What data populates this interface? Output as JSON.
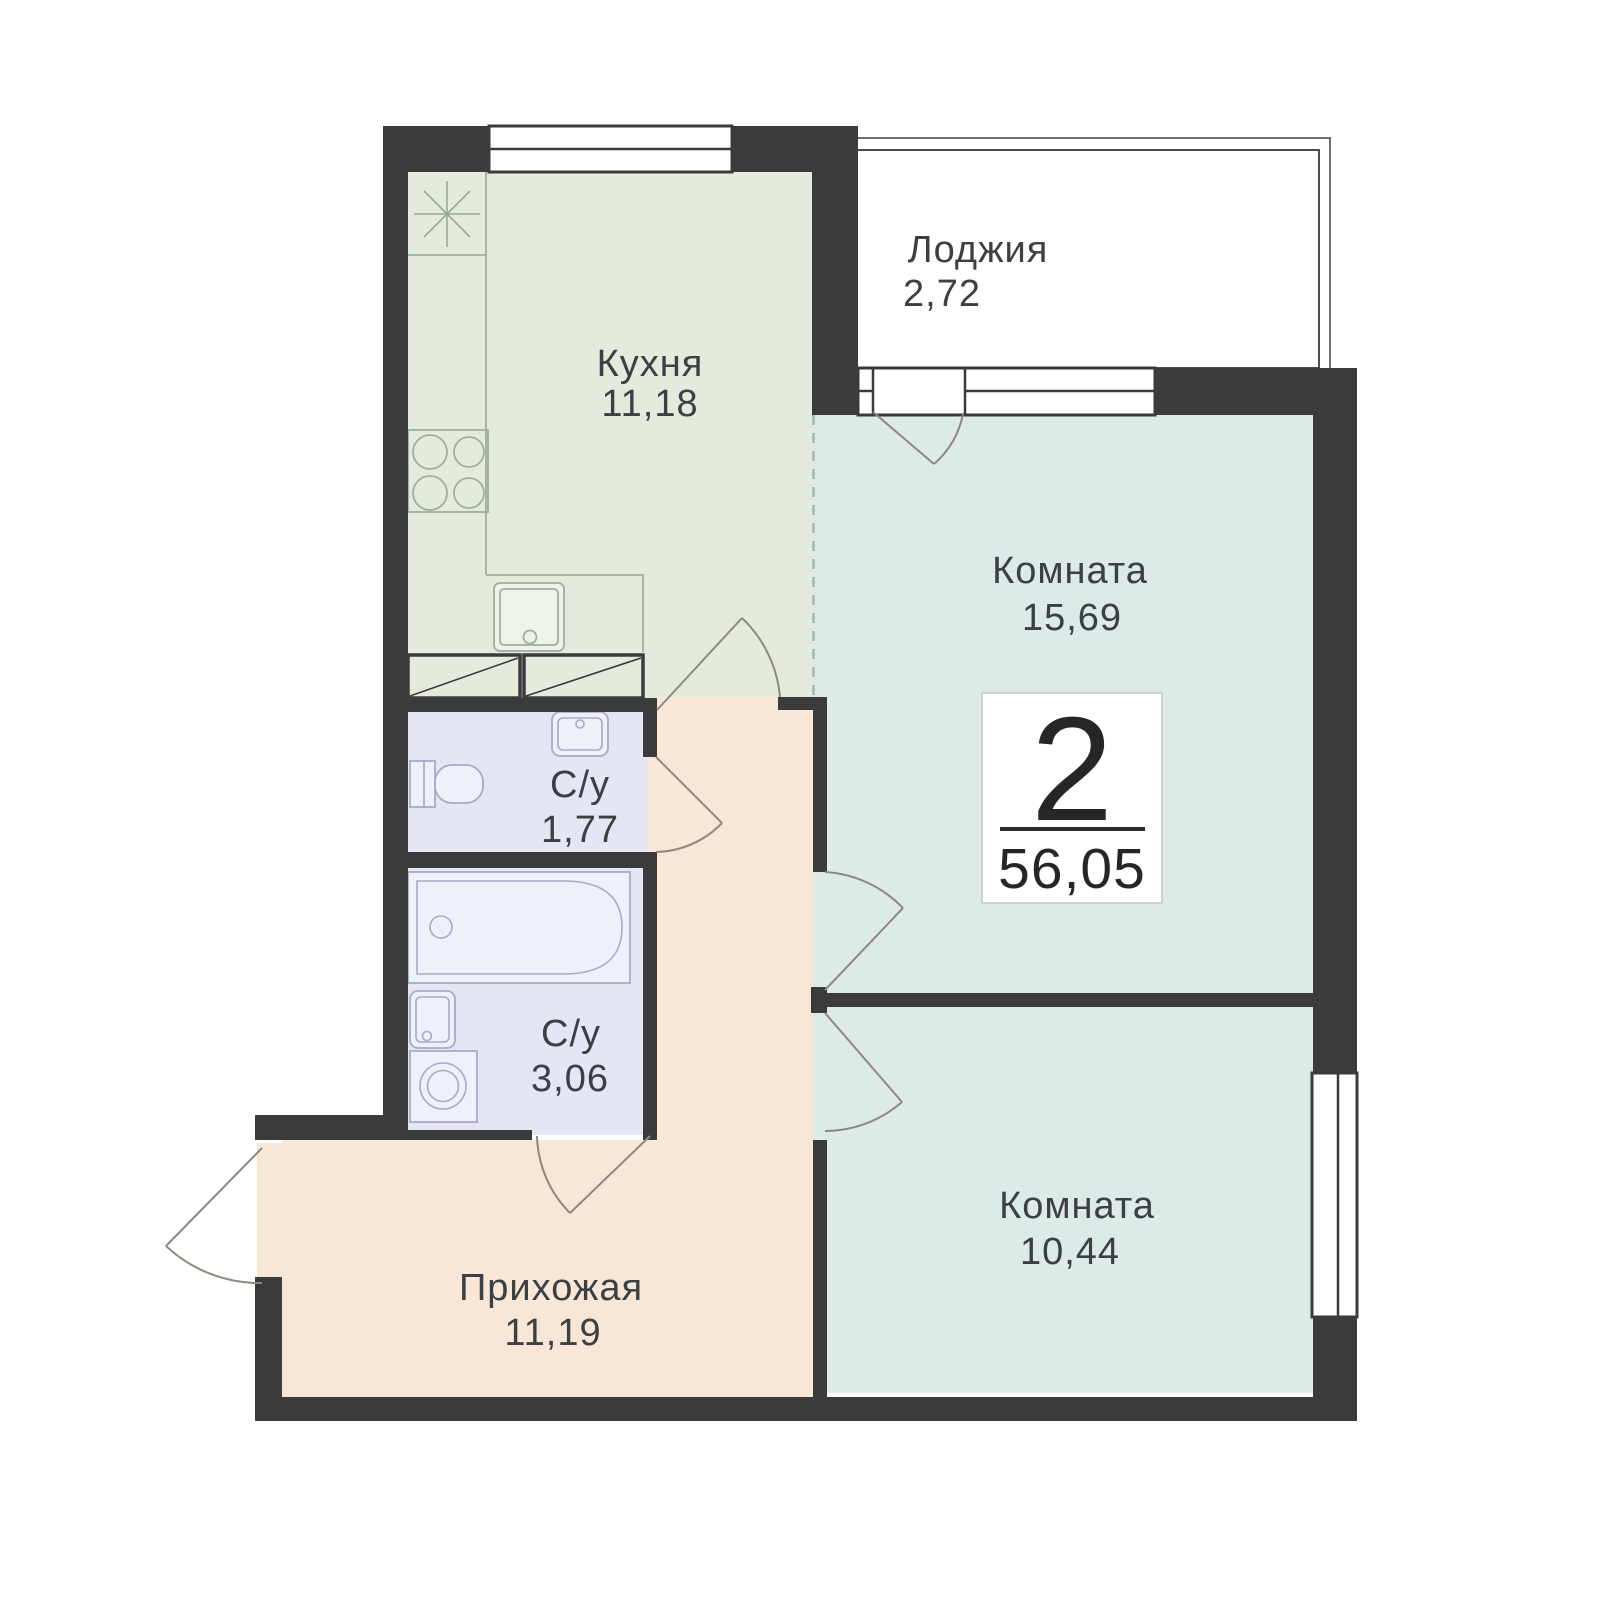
{
  "plan": {
    "badge": {
      "rooms_count": "2",
      "total_area": "56,05"
    },
    "rooms": [
      {
        "id": "kitchen",
        "name": "Кухня",
        "area": "11,18"
      },
      {
        "id": "loggia",
        "name": "Лоджия",
        "area": "2,72"
      },
      {
        "id": "room-main",
        "name": "Комната",
        "area": "15,69"
      },
      {
        "id": "bathroom-small",
        "name": "С/у",
        "area": "1,77"
      },
      {
        "id": "bathroom-large",
        "name": "С/у",
        "area": "3,06"
      },
      {
        "id": "hallway",
        "name": "Прихожая",
        "area": "11,19"
      },
      {
        "id": "room-second",
        "name": "Комната",
        "area": "10,44"
      }
    ],
    "colors": {
      "wall": "#3b3b3b",
      "kitchen_floor": "#e4ebdd",
      "room_floor": "#dcebe7",
      "loggia_floor": "#f9e9dc",
      "hallway_floor": "#f8e7d7",
      "bathroom_floor": "#e4e6f4",
      "badge_background": "#ffffff",
      "label_text": "#3c4043"
    }
  }
}
